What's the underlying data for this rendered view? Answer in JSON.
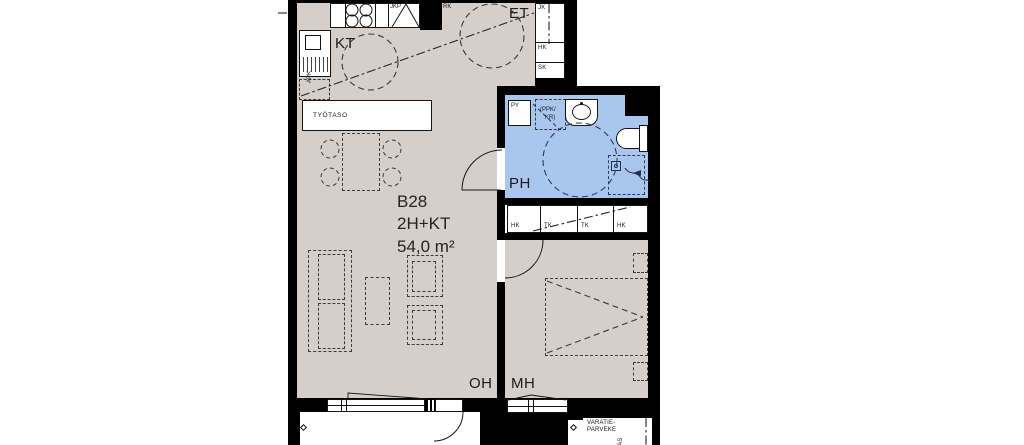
{
  "apartment": {
    "unit": "B28",
    "type": "2H+KT",
    "area": "54,0 m²"
  },
  "rooms": {
    "kitchen": "KT",
    "entry": "ET",
    "bathroom": "PH",
    "living_room": "OH",
    "bedroom": "MH"
  },
  "fixtures": {
    "worktop": "TYÖTASO",
    "fridge_freezer": "JKP",
    "electrical_panel": "RK",
    "dishwasher": "APK",
    "laundry_cabinet": "PY",
    "washer_dryer_line1": "(PPK/",
    "washer_dryer_line2": "KR)"
  },
  "closets": {
    "hall": [
      "JK",
      "HK",
      "SK"
    ],
    "row": [
      "HK",
      "TK",
      "TK",
      "HK"
    ]
  },
  "balcony": {
    "emergency_line1": "VARATIE-",
    "emergency_line2": "PARVEKE",
    "side_label": "KAS"
  },
  "colors": {
    "floor": "#d6cec8",
    "wet_room": "#a8c6ee",
    "wall": "#000000",
    "background": "#ffffff",
    "line": "#1c1c1c"
  }
}
